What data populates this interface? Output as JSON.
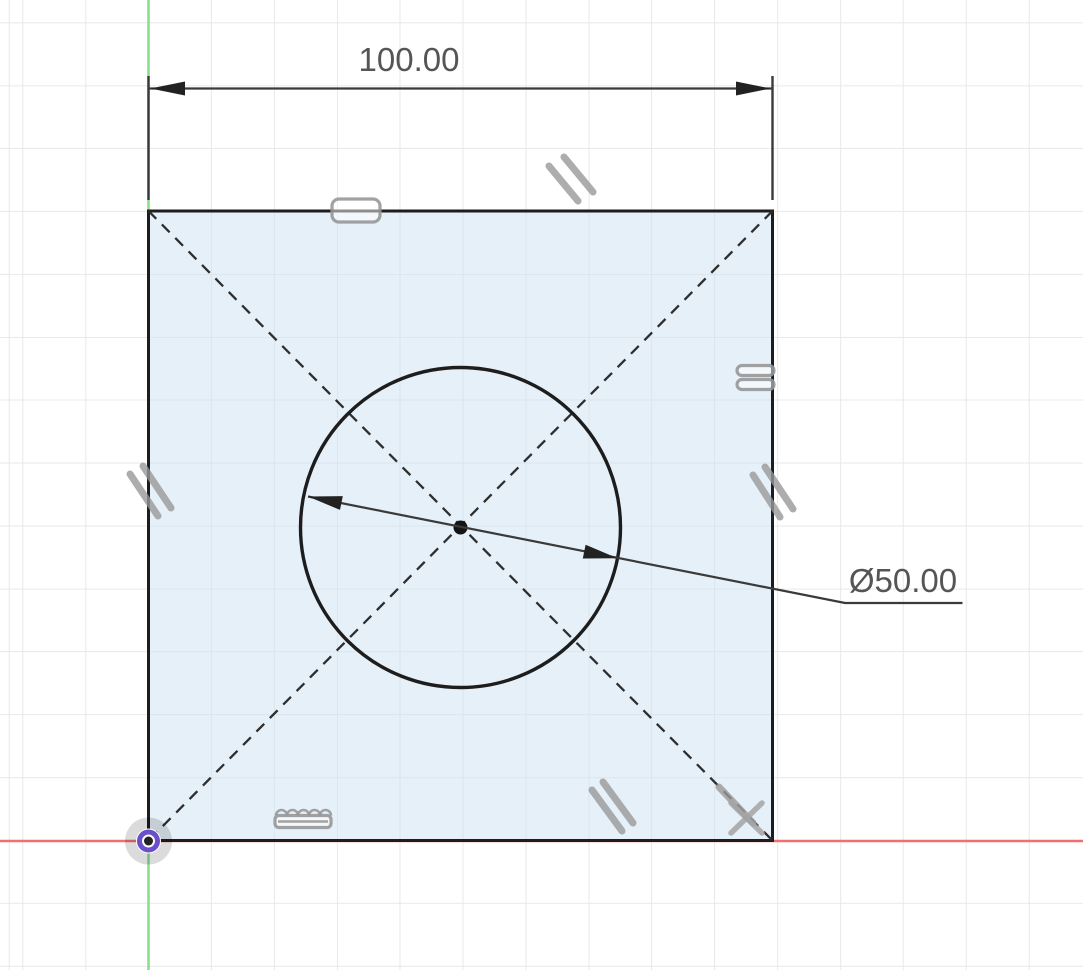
{
  "app": {
    "name": "cad-sketch-viewport",
    "mode": "sketch-edit"
  },
  "colors": {
    "grid": "#e8e8e8",
    "axis_x": "#f07070",
    "axis_y": "#8ae08a",
    "sketch_stroke": "#1d1d1d",
    "construction": "#2e2e2e",
    "dimension": "#3a3a3a",
    "dimension_text": "#555555",
    "constraint": "#989898",
    "origin_purple": "#6a4fc9",
    "center_dot": "#141414"
  },
  "canvas": {
    "width_px": 1083,
    "height_px": 970,
    "grid_spacing_px": 62.9
  },
  "sketch": {
    "square": {
      "side": 100,
      "fill": "light-blue-profile"
    },
    "circle": {
      "diameter": 50,
      "center_on_square_center": true
    },
    "dimensions": [
      {
        "type": "linear-horizontal",
        "value": "100.00",
        "entity": "square-top-edge"
      },
      {
        "type": "diameter",
        "value": "Ø50.00",
        "entity": "center-circle"
      }
    ],
    "construction_lines": [
      {
        "name": "diagonal-tl-br",
        "style": "dashed"
      },
      {
        "name": "diagonal-tr-bl",
        "style": "dashed"
      }
    ],
    "constraints": [
      {
        "icon": "horizontal-bar-icon",
        "location": "top-edge"
      },
      {
        "icon": "parallel-slashes-icon",
        "location": "above-top-edge"
      },
      {
        "icon": "equal-bars-icon",
        "location": "right-edge-upper"
      },
      {
        "icon": "parallel-slashes-icon",
        "location": "left-edge-middle"
      },
      {
        "icon": "parallel-slashes-icon",
        "location": "right-edge-middle"
      },
      {
        "icon": "parallel-slashes-icon",
        "location": "bottom-right-inside"
      },
      {
        "icon": "comb-bar-icon",
        "location": "bottom-edge"
      },
      {
        "icon": "diagonal-tick-icon",
        "location": "bottom-right-diagonal"
      },
      {
        "icon": "cross-marker-icon",
        "location": "bottom-right-corner"
      }
    ],
    "origin": {
      "marker": "origin-point",
      "at_square_corner": "bottom-left"
    }
  }
}
